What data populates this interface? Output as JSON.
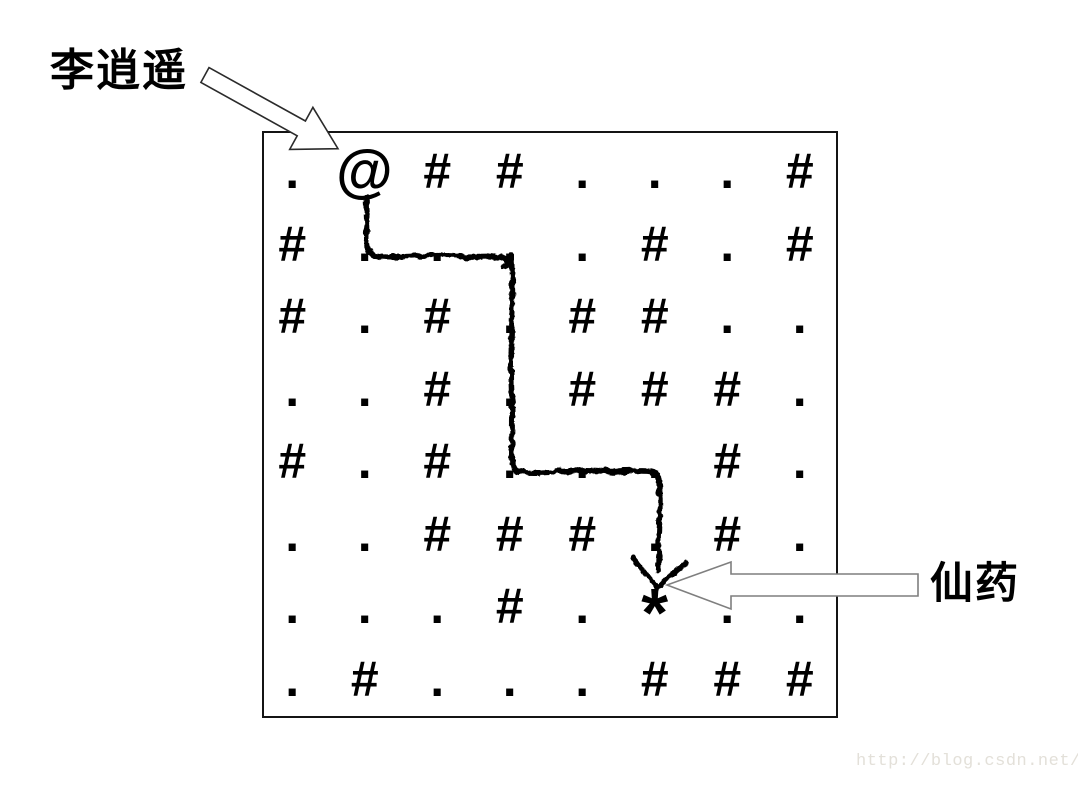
{
  "diagram": {
    "start_label": "李逍遥",
    "goal_label": "仙药"
  },
  "maze": {
    "rows": [
      ".@##...#",
      "#....#.#",
      "#.#.##..",
      "..#.###.",
      "#.#...#.",
      "..###.#.",
      "...#.*..",
      ".#...###"
    ],
    "symbols": {
      "start": "@",
      "wall": "#",
      "floor": ".",
      "goal": "*"
    }
  },
  "watermark": {
    "text": "http://blog.csdn.net/",
    "color": "#e3e0d9"
  },
  "colors": {
    "ink": "#000000",
    "background": "#ffffff",
    "box_border": "#141414",
    "start_arrow_outline": "#2b2b2b",
    "goal_arrow_outline": "#7f7f7f",
    "path_ink": "#000000"
  }
}
